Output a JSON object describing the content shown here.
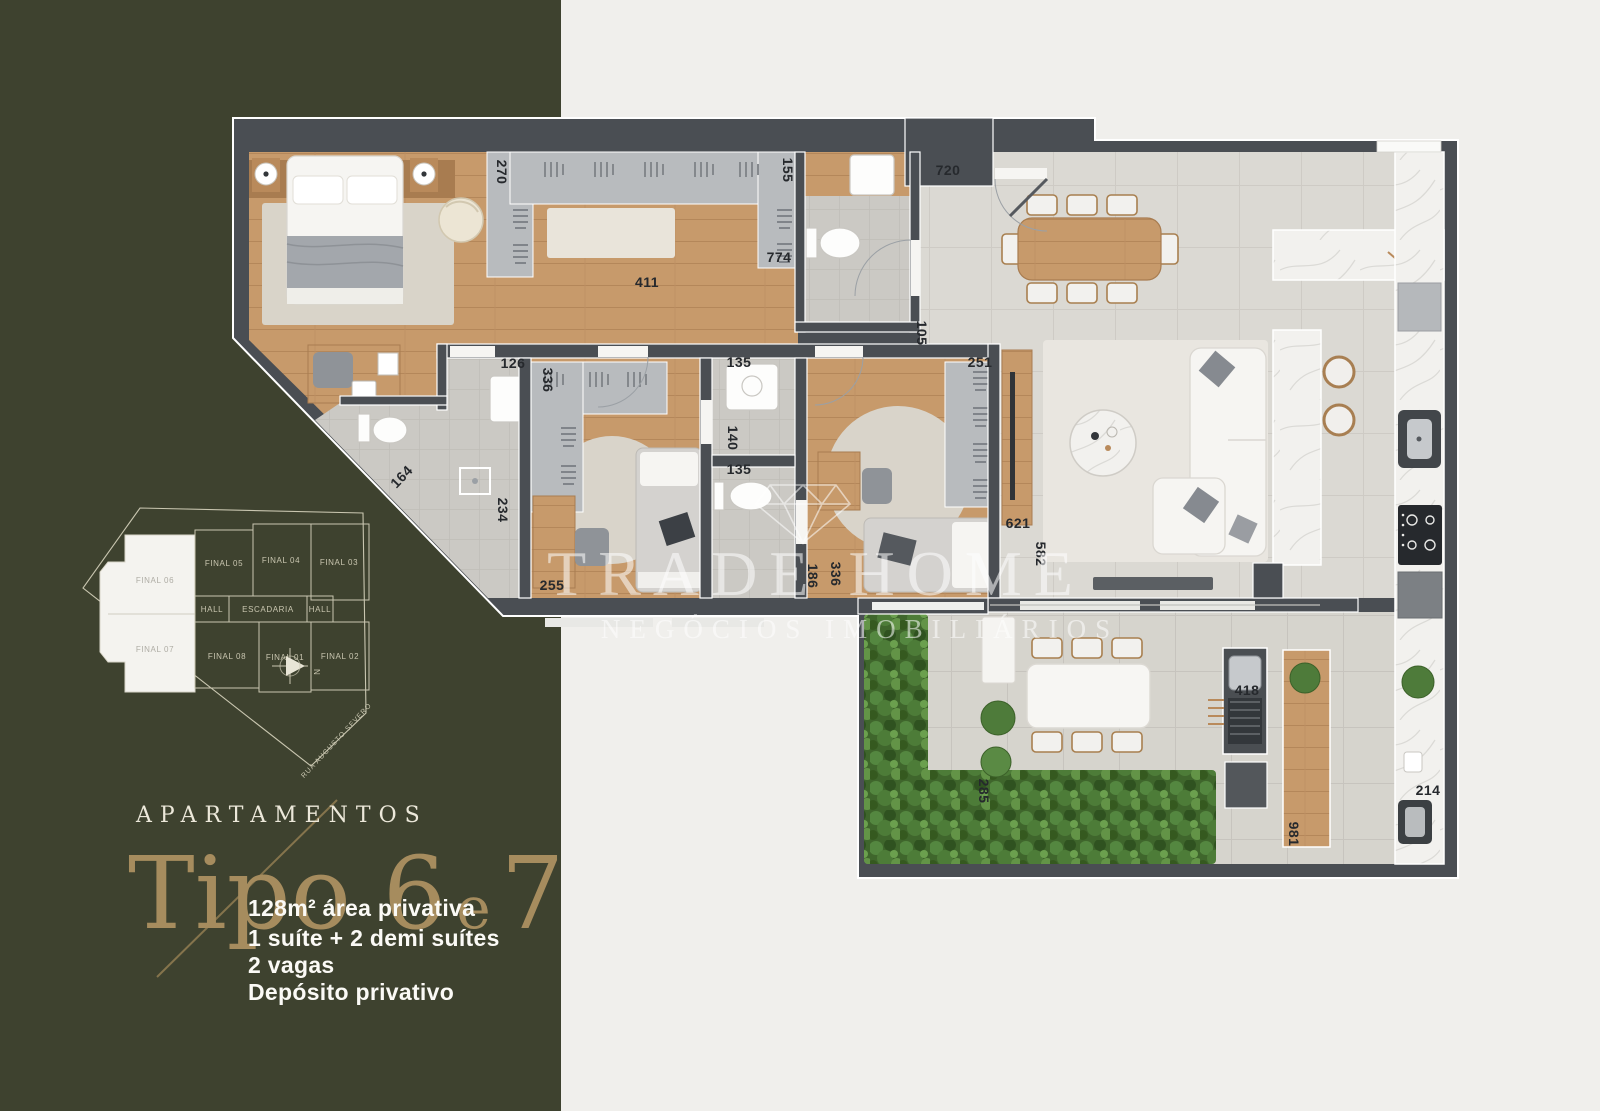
{
  "brand_panel": {
    "eyebrow": "APARTAMENTOS",
    "title_parts": {
      "main": "Tipo 6",
      "conn": "e",
      "num": "7"
    },
    "details": [
      "128m² área privativa",
      "1 suíte + 2 demi suítes",
      "2 vagas",
      "Depósito privativo"
    ]
  },
  "keyplan": {
    "highlighted_units": [
      {
        "label": "FINAL 06"
      },
      {
        "label": "FINAL 07"
      }
    ],
    "units": [
      {
        "label": "FINAL 05"
      },
      {
        "label": "FINAL 04"
      },
      {
        "label": "FINAL 03"
      },
      {
        "label": "HALL"
      },
      {
        "label": "ESCADARIA"
      },
      {
        "label": "HALL"
      },
      {
        "label": "FINAL 08"
      },
      {
        "label": "FINAL 01"
      },
      {
        "label": "FINAL 02"
      }
    ],
    "street": "RUA AUGUSTO SEVERO",
    "compass": "N"
  },
  "watermark": {
    "brand": "TRADE HOME",
    "tagline": "NEGÓCIOS IMOBILIÁRIOS"
  },
  "floorplan": {
    "measurements": [
      {
        "value": "270"
      },
      {
        "value": "155"
      },
      {
        "value": "720"
      },
      {
        "value": "774"
      },
      {
        "value": "411"
      },
      {
        "value": "126"
      },
      {
        "value": "336"
      },
      {
        "value": "135"
      },
      {
        "value": "140"
      },
      {
        "value": "135"
      },
      {
        "value": "105"
      },
      {
        "value": "251"
      },
      {
        "value": "164"
      },
      {
        "value": "234"
      },
      {
        "value": "255"
      },
      {
        "value": "186"
      },
      {
        "value": "336"
      },
      {
        "value": "621"
      },
      {
        "value": "582"
      },
      {
        "value": "285"
      },
      {
        "value": "418"
      },
      {
        "value": "981"
      },
      {
        "value": "214"
      }
    ]
  },
  "colors": {
    "brand_green": "#3e422f",
    "gold": "#a68c5e",
    "wall": "#4a4e53",
    "wood": "#c79a6b",
    "tile": "#dbd9d3",
    "hedge": "#3f662c",
    "marble": "#f2f1ee"
  }
}
